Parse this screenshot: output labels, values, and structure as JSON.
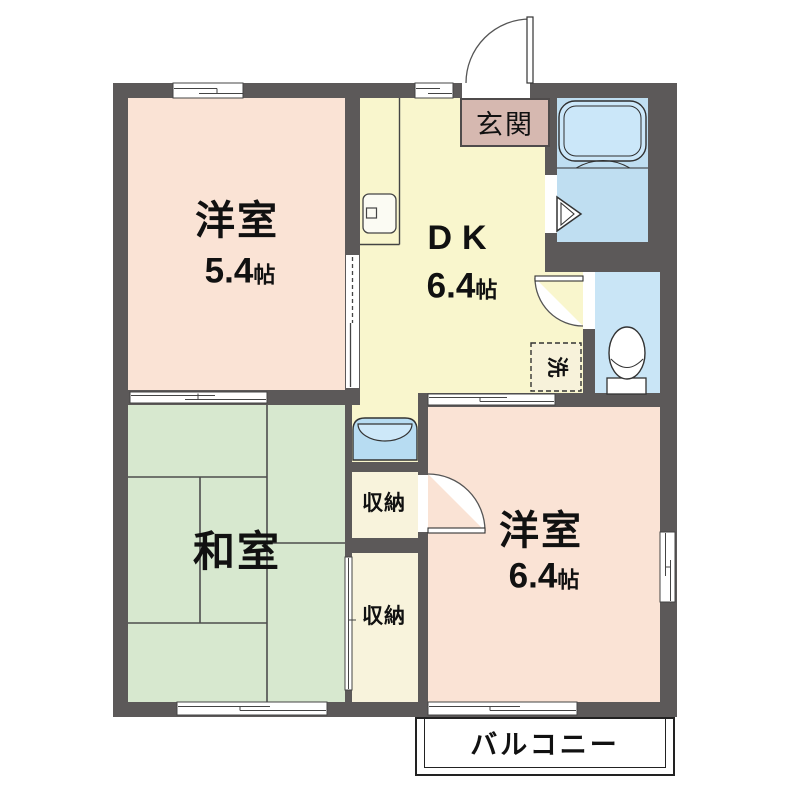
{
  "rooms": {
    "western_room_1": {
      "name": "洋室",
      "size": "5.4",
      "size_unit": "帖"
    },
    "dining_kitchen": {
      "name": "DK",
      "size": "6.4",
      "size_unit": "帖"
    },
    "japanese_room": {
      "name": "和室"
    },
    "western_room_2": {
      "name": "洋室",
      "size": "6.4",
      "size_unit": "帖"
    },
    "entrance": {
      "label": "玄関"
    },
    "closet_upper": {
      "label": "収納"
    },
    "closet_lower": {
      "label": "収納"
    },
    "laundry_space": {
      "label": "洗"
    },
    "balcony": {
      "label": "バルコニー"
    }
  },
  "fixtures": {
    "bathtub": "bathtub-icon",
    "toilet": "toilet-icon",
    "washbasin": "washbasin-icon",
    "kitchen_sink": "kitchen-sink-icon",
    "entrance_door": "entrance-door-arc",
    "bathroom_door": "folding-door-triangle-icon"
  },
  "colors": {
    "wall": "#5c5959",
    "western_room": "#fae3d5",
    "dining_kitchen": "#f9f6cd",
    "japanese_room": "#d7e8cf",
    "closet": "#f8f3dc",
    "bathroom": "#bfdef1",
    "toilet_room": "#c9e5f6",
    "entrance_mat": "#d6b8b0",
    "outline": "#333333",
    "background": "#ffffff"
  }
}
